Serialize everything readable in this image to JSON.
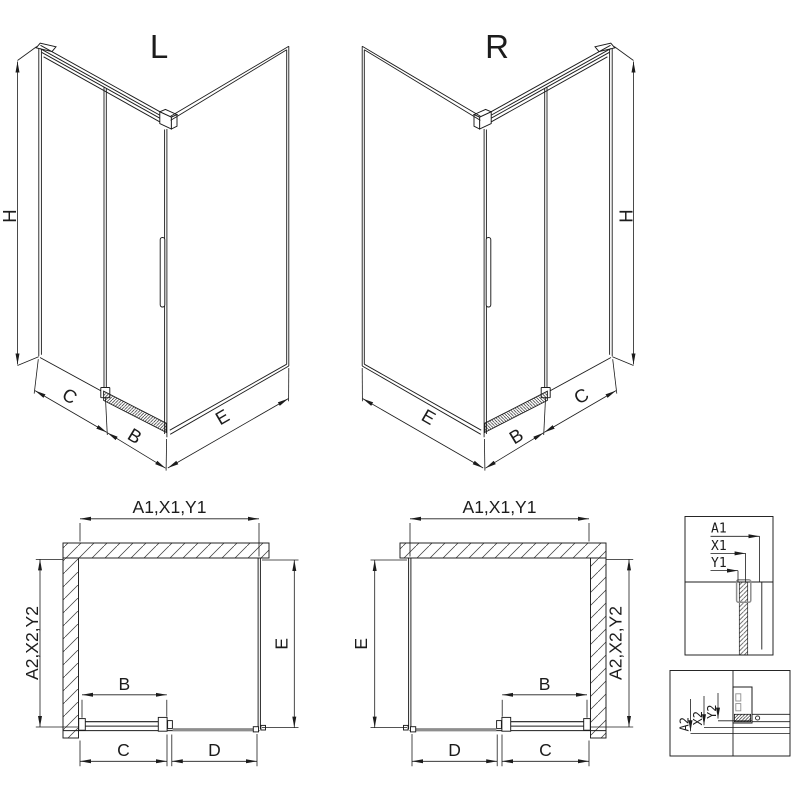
{
  "colors": {
    "ink": "#1c1c1c",
    "gray": "#8e8e8e",
    "bg": "#ffffff"
  },
  "views": {
    "l3d": {
      "title": "L",
      "h": "H",
      "c": "C",
      "b": "B",
      "e": "E"
    },
    "r3d": {
      "title": "R",
      "h": "H",
      "c": "C",
      "b": "B",
      "e": "E"
    },
    "lplan": {
      "top": "A1,X1,Y1",
      "side": "A2,X2,Y2",
      "e": "E",
      "b": "B",
      "c": "C",
      "d": "D"
    },
    "rplan": {
      "top": "A1,X1,Y1",
      "side": "A2,X2,Y2",
      "e": "E",
      "b": "B",
      "c": "C",
      "d": "D"
    },
    "detail1": {
      "a": "A1",
      "x": "X1",
      "y": "Y1"
    },
    "detail2": {
      "a": "A2",
      "x": "X2",
      "y": "Y2"
    }
  }
}
